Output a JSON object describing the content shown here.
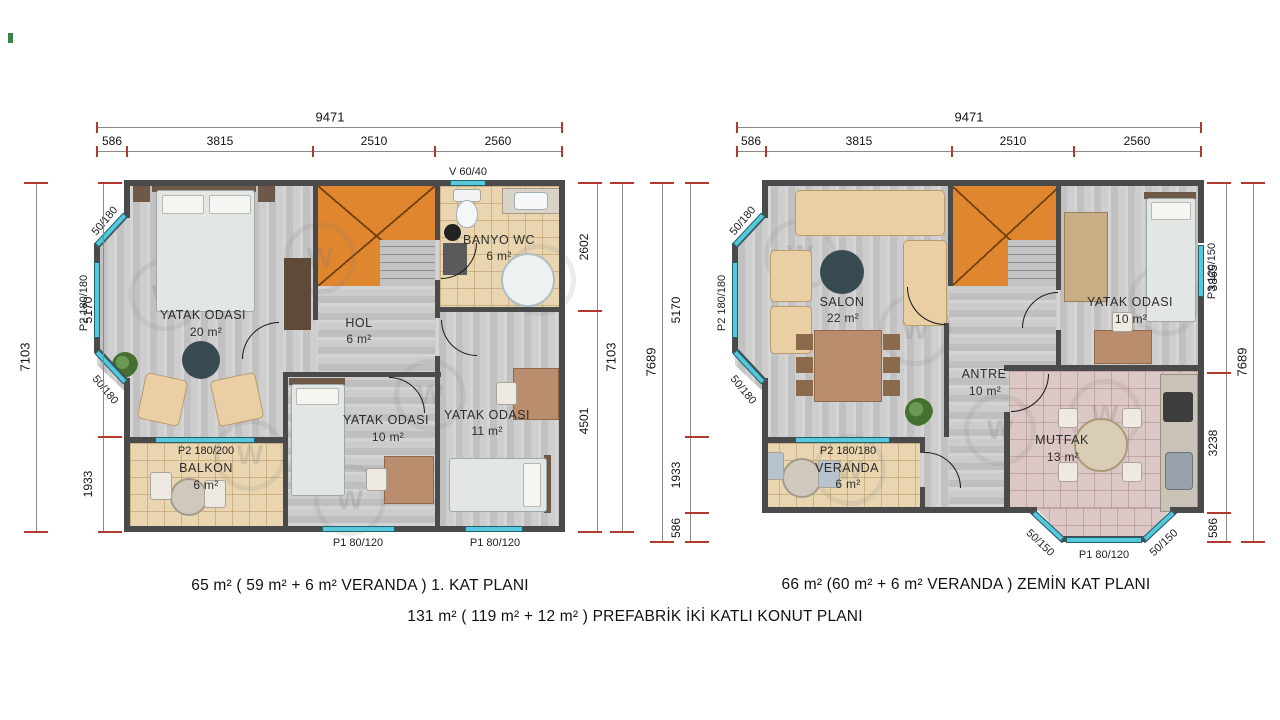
{
  "watermark": "W",
  "captions": {
    "left": "65 m²  ( 59 m² + 6 m²  VERANDA ) 1. KAT  PLANI",
    "right": "66 m² (60 m² + 6 m² VERANDA ) ZEMİN  KAT  PLANI",
    "bottom": "131  m²  ( 119 m² + 12 m² )  PREFABRİK İKİ KATLI KONUT PLANI"
  },
  "left_plan": {
    "dims": {
      "top_total": "9471",
      "top_segments": [
        "586",
        "3815",
        "2510",
        "2560"
      ],
      "left_outer": "7103",
      "left_segments": [
        "5170",
        "1933"
      ],
      "right_outer": "7103",
      "right_segments": [
        "2602",
        "4501"
      ]
    },
    "windows": {
      "vent": "V 60/40",
      "bay_top": "50/180",
      "bay_mid": "P2 180/180",
      "bay_bottom": "50/180",
      "balcony": "P2 180/200",
      "bottom_left": "P1 80/120",
      "bottom_right": "P1 80/120"
    },
    "rooms": {
      "bedroom_main": {
        "name": "YATAK  ODASI",
        "area": "20 m²"
      },
      "hall": {
        "name": "HOL",
        "area": "6 m²"
      },
      "bath": {
        "name": "BANYO WC",
        "area": "6 m²"
      },
      "bedroom_mid": {
        "name": "YATAK  ODASI",
        "area": "10 m²"
      },
      "bedroom_right": {
        "name": "YATAK  ODASI",
        "area": "11 m²"
      },
      "balcony": {
        "name": "BALKON",
        "area": "6 m²"
      }
    }
  },
  "right_plan": {
    "dims": {
      "top_total": "9471",
      "top_segments": [
        "586",
        "3815",
        "2510",
        "2560"
      ],
      "left_outer": "7689",
      "left_segments": [
        "5170",
        "1933",
        "586"
      ],
      "right_outer": "7689",
      "right_segments": [
        "3865",
        "3238",
        "586"
      ]
    },
    "windows": {
      "bay_top": "50/180",
      "bay_mid": "P2 180/180",
      "bay_bottom": "50/180",
      "bedroom_side": "P3 120/150",
      "veranda": "P2 180/180",
      "kitchen_bay_left": "50/150",
      "kitchen_bay_right": "50/150",
      "kitchen_bottom": "P1 80/120"
    },
    "rooms": {
      "living": {
        "name": "SALON",
        "area": "22 m²"
      },
      "bedroom": {
        "name": "YATAK ODASI",
        "area": "10 m²"
      },
      "entry": {
        "name": "ANTRE",
        "area": "10 m²"
      },
      "kitchen": {
        "name": "MUTFAK",
        "area": "13 m²"
      },
      "veranda": {
        "name": "VERANDA",
        "area": "6 m²"
      }
    }
  }
}
